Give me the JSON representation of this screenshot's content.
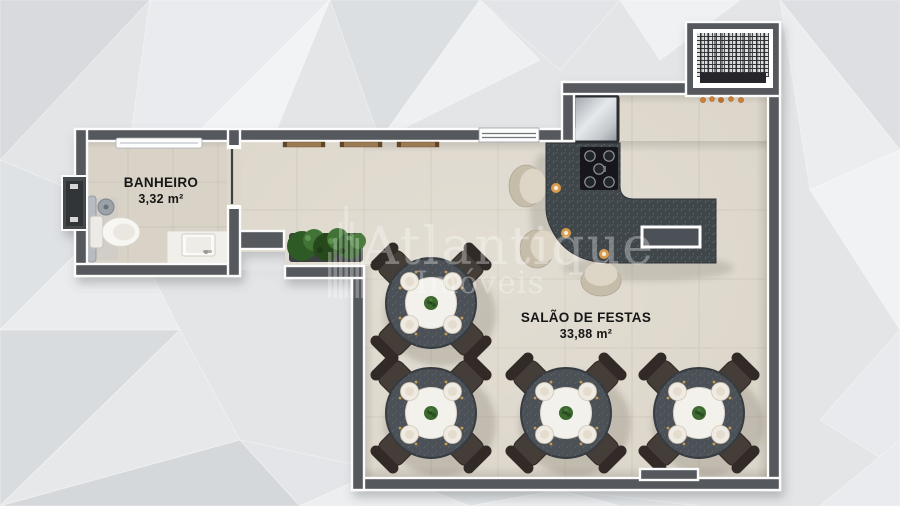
{
  "rooms": {
    "banheiro": {
      "name": "BANHEIRO",
      "area": "3,32 m²"
    },
    "salao": {
      "name": "SALÃO DE FESTAS",
      "area": "33,88 m²"
    }
  },
  "watermark": {
    "brand": "Atlantique",
    "subtitle": "Imóveis"
  },
  "colors": {
    "wall": "#54585c",
    "wall_trim": "#fbfbfb",
    "floor_bath": "#d8d2c7",
    "floor_salon": "#ddd7cb",
    "counter": "#41464c",
    "table": "#4b5157",
    "chair": "#453c37",
    "stool": "#ddd5c6",
    "plate": "#f3f1ec",
    "plant": "#3c672f",
    "accent_amber": "#d89a4e",
    "label_ink": "#161616",
    "background": "#e4e5e7",
    "watermark": "#ffffff"
  }
}
